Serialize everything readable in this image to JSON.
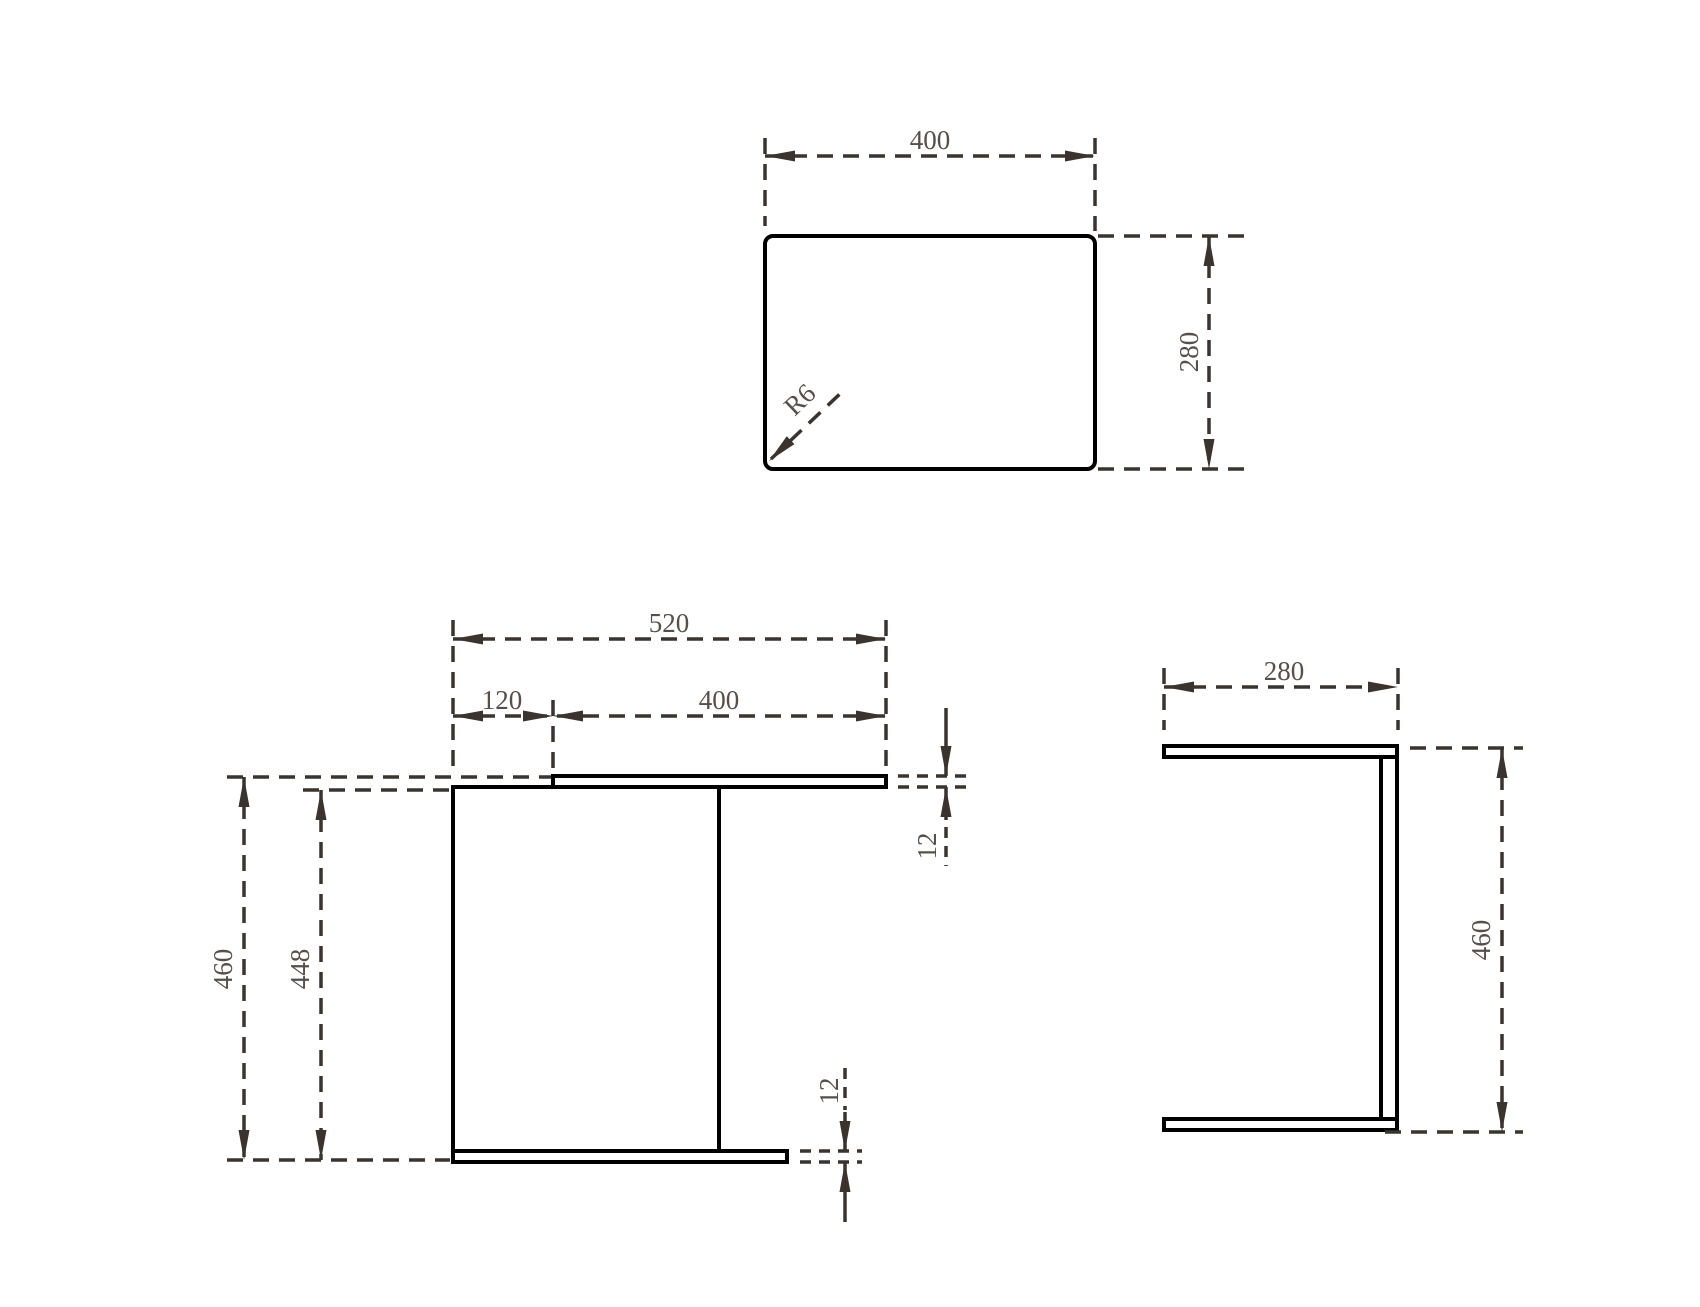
{
  "drawing": {
    "type": "orthographic-projection-furniture-drawing",
    "views": {
      "top": {
        "title": "top-view",
        "dims": {
          "width_label": "400",
          "depth_label": "280",
          "corner_radius_label": "R6"
        }
      },
      "front": {
        "title": "front-view",
        "dims": {
          "overall_width_label": "520",
          "overhang_label": "120",
          "top_width_label": "400",
          "overall_height_label": "460",
          "panel_height_label": "448",
          "top_thickness_label": "12",
          "bottom_thickness_label": "12"
        }
      },
      "side": {
        "title": "side-view",
        "dims": {
          "depth_label": "280",
          "height_label": "460"
        }
      }
    },
    "colors": {
      "object_line": "#000000",
      "dim_line": "#3a332e",
      "dim_text": "#574f48",
      "background": "#ffffff"
    }
  }
}
